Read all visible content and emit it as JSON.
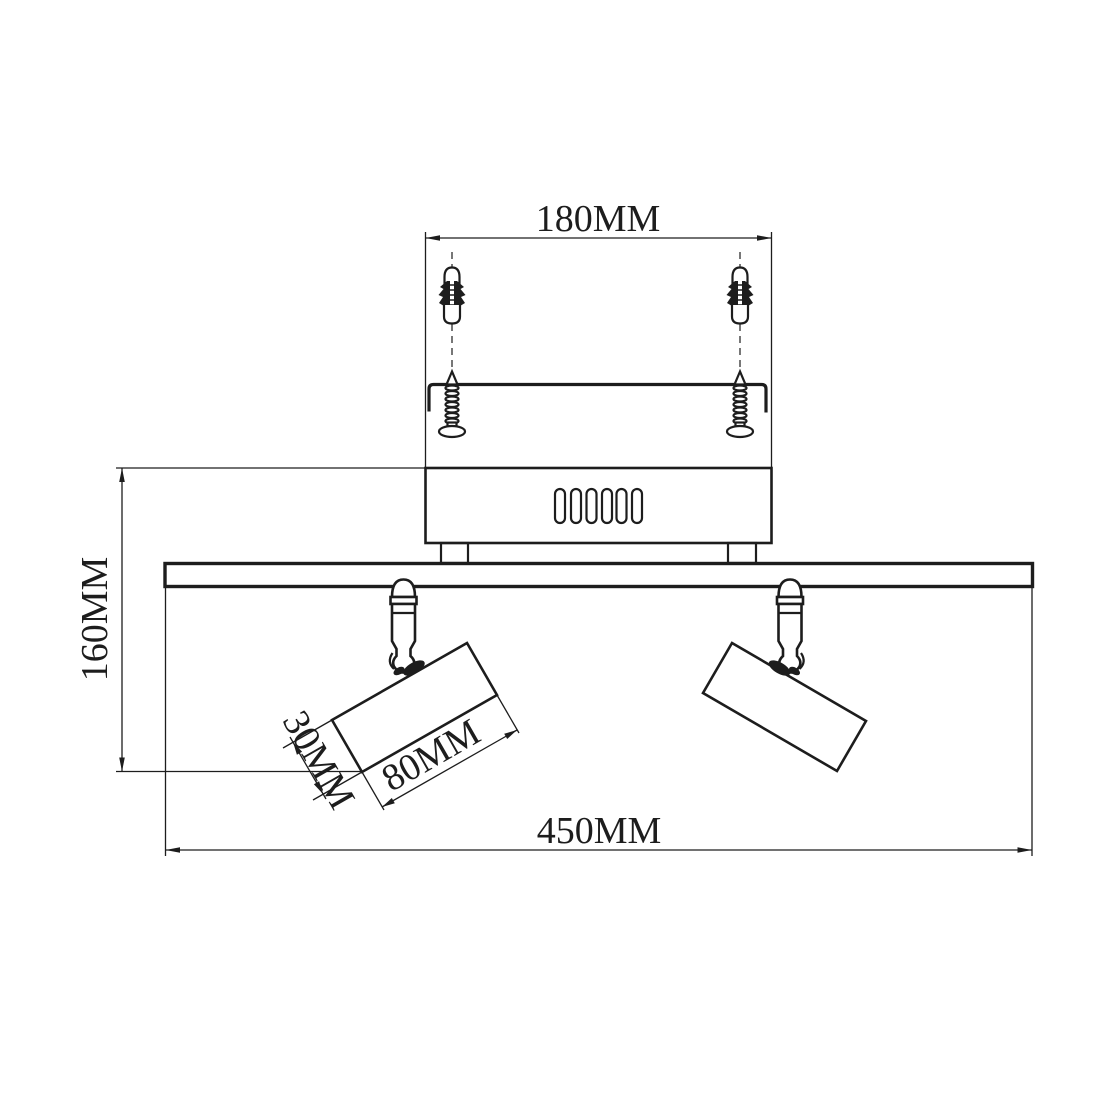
{
  "diagram": {
    "unit": "MM",
    "background_color": "#ffffff",
    "line_color": "#1d1d1d",
    "labels": {
      "mounting_hole_spacing": "180MM",
      "overall_height": "160MM",
      "head_diameter": "30MM",
      "head_length": "80MM",
      "overall_width": "450MM"
    }
  }
}
